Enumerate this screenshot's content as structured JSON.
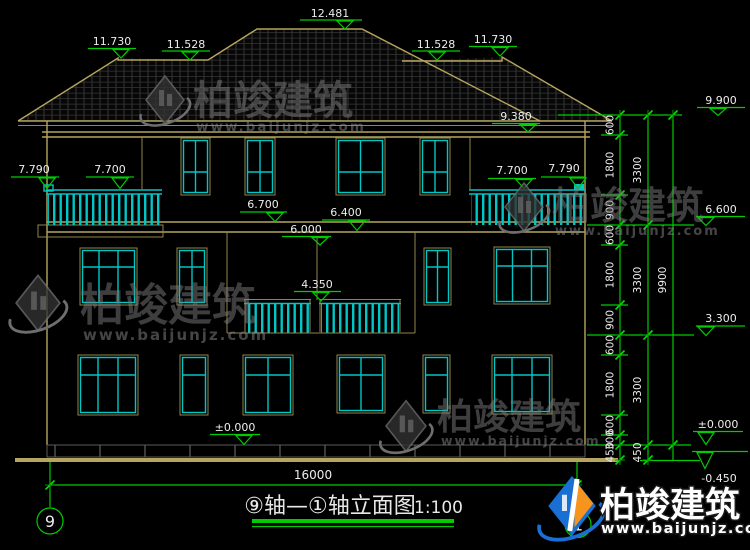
{
  "drawing": {
    "title": "⑨轴—①轴立面图",
    "scale": "1:100",
    "axis_left": "9",
    "axis_right": "1",
    "bottom_dim": "16000",
    "elevation_marks": [
      "12.481",
      "11.730",
      "11.528",
      "11.528",
      "11.730",
      "9.380",
      "9.900",
      "7.790",
      "7.700",
      "7.700",
      "7.790",
      "6.700",
      "6.400",
      "6.000",
      "4.350",
      "6.600",
      "3.300",
      "±0.000",
      "±0.000",
      "-0.450"
    ],
    "dims_col1": [
      "600",
      "1800",
      "900",
      "600",
      "1800",
      "900",
      "600",
      "1800",
      "600",
      "300",
      "450"
    ],
    "dims_col2": [
      "3300",
      "3300",
      "3300",
      "450"
    ],
    "dims_col3": [
      "9900"
    ],
    "watermark": {
      "name": "柏竣建筑",
      "url": "www.baijunjz.com"
    },
    "brand": {
      "name": "柏竣建筑",
      "url": "www.baijunjz.com"
    },
    "colors": {
      "background": "#000000",
      "outline_tan": "#b6a55e",
      "window_cyan": "#00c6c6",
      "dimension_green": "#00cc00",
      "text_white": "#ededed",
      "brand_blue": "#1a6fd4",
      "brand_orange": "#f7941d"
    }
  }
}
